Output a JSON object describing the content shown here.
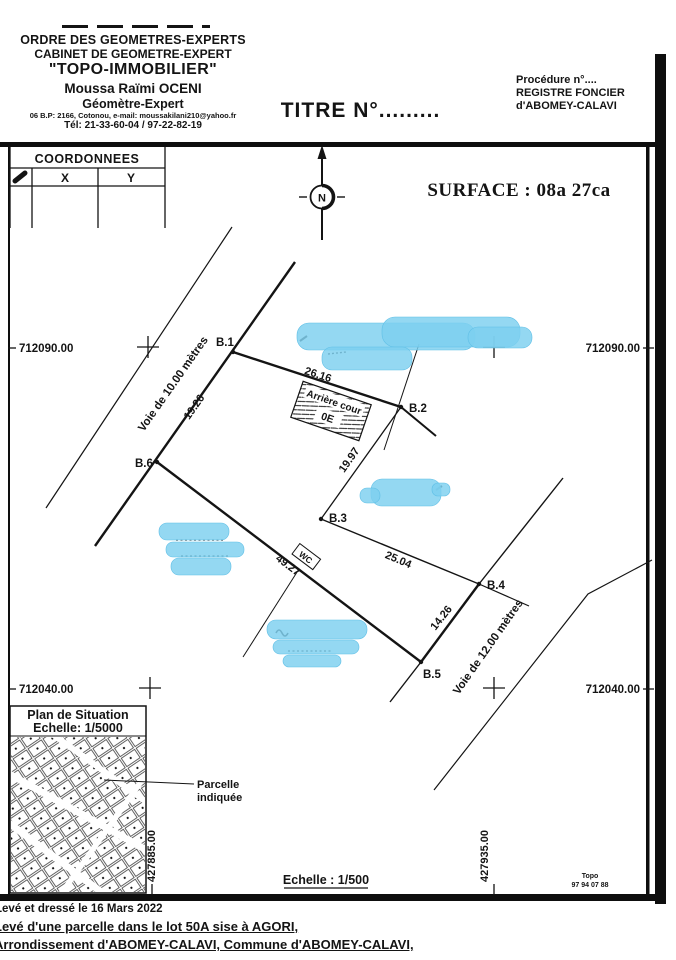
{
  "header": {
    "org_line1": "ORDRE DES GEOMETRES-EXPERTS",
    "org_line2": "CABINET DE GEOMETRE-EXPERT",
    "cabinet": "\"TOPO-IMMOBILIER\"",
    "surveyor": "Moussa Raïmi OCENI",
    "surveyor_title": "Géomètre-Expert",
    "contact": "06 B.P: 2166, Cotonou, e-mail: moussakilani210@yahoo.fr",
    "phone": "Tél: 21-33-60-04 / 97-22-82-19",
    "title_number": "TITRE N°.........",
    "procedure": "Procédure n°....",
    "registry_line1": "REGISTRE FONCIER",
    "registry_line2": "d'ABOMEY-CALAVI"
  },
  "coordinates_table": {
    "title": "COORDONNEES",
    "col_x": "X",
    "col_y": "Y"
  },
  "surface": "SURFACE : 08a 27ca",
  "north_label": "N",
  "grid": {
    "y_top": "712090.00",
    "y_bottom": "712040.00",
    "x_left": "427885.00",
    "x_right": "427935.00"
  },
  "points": {
    "b1": "B.1",
    "b2": "B.2",
    "b3": "B.3",
    "b4": "B.4",
    "b5": "B.5",
    "b6": "B.6"
  },
  "dimensions": {
    "b1b2": "26.16",
    "b2b3": "19.97",
    "b3b4": "25.04",
    "b4b5": "14.26",
    "b6b5": "49.27",
    "b6b1": "19.26"
  },
  "roads": {
    "west": "Voie de 10.00 mètres",
    "east": "Voie de 12.00 mètres"
  },
  "features": {
    "back_yard": "Arrière cour",
    "back_yard_code": "0E",
    "toilet": "WC"
  },
  "situation_map": {
    "title": "Plan de Situation",
    "scale": "Echelle: 1/5000",
    "callout_line1": "Parcelle",
    "callout_line2": "indiquée"
  },
  "main_scale": "Echelle : 1/500",
  "stamp": {
    "line1": "Topo",
    "line2": "97 94 07 88"
  },
  "footer": {
    "line1": "Levé et dressé le 16 Mars 2022",
    "line2": "Levé d'une parcelle dans le lot 50A sise à AGORI,",
    "line3": "Arrondissement d'ABOMEY-CALAVI, Commune d'ABOMEY-CALAVI,"
  },
  "colors": {
    "ink": "#141414",
    "redaction_blue": "#7ccfef",
    "paper": "#ffffff"
  }
}
